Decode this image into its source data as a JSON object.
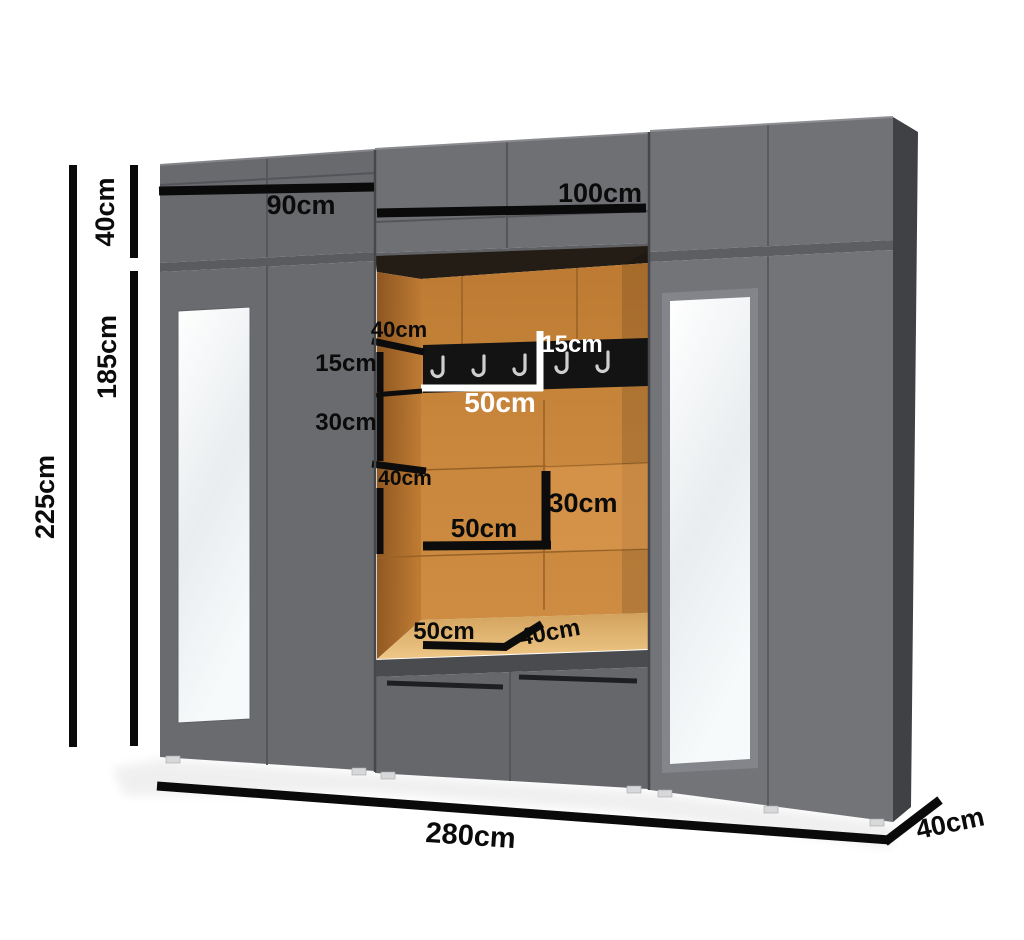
{
  "diagram": {
    "type": "furniture-dimension-diagram",
    "subject": "hallway wardrobe with open niche, coat rack and mirrors"
  },
  "colors": {
    "cabinet_gray": "#6d6e72",
    "cabinet_side_gray": "#404145",
    "niche_orange": "#c6833a",
    "niche_wall_dark": "#9a6026",
    "bench_wood": "#e8bd77",
    "rack_black": "#131313",
    "hook_gray": "#cfcfcf",
    "mirror_white": "#f4f7f8",
    "dimension_black": "#0a0a0a",
    "label_white": "#ffffff",
    "background": "#ffffff"
  },
  "dimensions": {
    "total_height": "225cm",
    "upper_section_height": "40cm",
    "main_section_height": "185cm",
    "left_section_width": "90cm",
    "middle_section_width": "100cm",
    "total_width": "280cm",
    "depth": "40cm"
  },
  "niche": {
    "top_shelf_depth": "40cm",
    "upper_gap_height": "15cm",
    "rack_height": "15cm",
    "rack_width": "50cm",
    "lower_gap_height": "30cm",
    "middle_shelf_depth": "40cm",
    "cubby_width": "50cm",
    "cubby_height": "30cm",
    "bench_width": "50cm",
    "bench_depth": "40cm",
    "hook_count": 5
  }
}
